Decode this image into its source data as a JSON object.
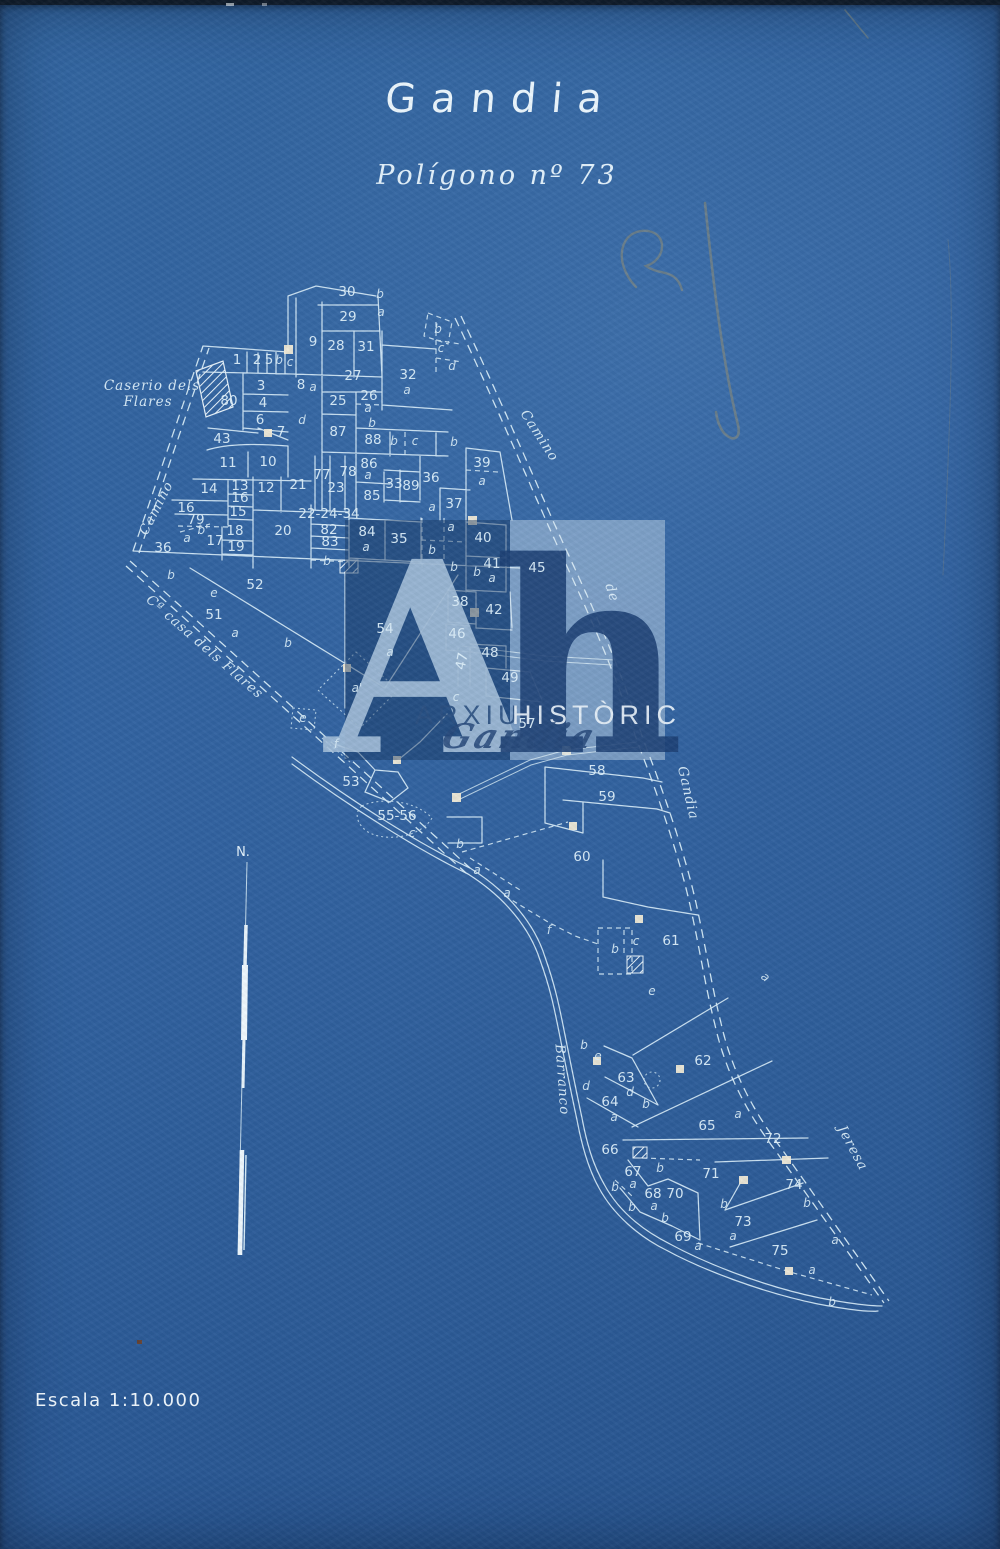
{
  "page": {
    "title": "Gandia",
    "subtitle": "Polígono nº 73",
    "scale_label": "Escala 1:10.000",
    "north_label": "N."
  },
  "colors": {
    "paper_blue": "#2e5f9e",
    "ink": "#d7ecf8",
    "watermark_dark": "#1d4075",
    "watermark_light_box": "#dce9f4",
    "building_fill": "#f1ead6",
    "pencil": "#97906f"
  },
  "watermark": {
    "letter_a": "A",
    "letter_h": "h",
    "text_1": "ARXIU",
    "text_2": "HISTÒRIC",
    "text_3": "Gandia"
  },
  "map": {
    "place_labels": [
      {
        "text": "Caserio dels",
        "x": 152,
        "y": 390,
        "rotate": 0,
        "size": 14,
        "spacing": 1
      },
      {
        "text": "Flares",
        "x": 148,
        "y": 406,
        "rotate": 0,
        "size": 14,
        "spacing": 1
      },
      {
        "text": "Camino",
        "x": 160,
        "y": 510,
        "rotate": -63,
        "size": 16,
        "spacing": 4
      },
      {
        "text": "Camino",
        "x": 536,
        "y": 438,
        "rotate": 57,
        "size": 16,
        "spacing": 9
      },
      {
        "text": "de",
        "x": 608,
        "y": 594,
        "rotate": 72,
        "size": 15,
        "spacing": 4
      },
      {
        "text": "Gandia",
        "x": 684,
        "y": 794,
        "rotate": 77,
        "size": 16,
        "spacing": 7
      },
      {
        "text": "Barranco",
        "x": 558,
        "y": 1080,
        "rotate": 86,
        "size": 16,
        "spacing": 6
      },
      {
        "text": "Jeresa",
        "x": 849,
        "y": 1150,
        "rotate": 62,
        "size": 16,
        "spacing": 7
      },
      {
        "text": "Cª casa dels Flares",
        "x": 202,
        "y": 650,
        "rotate": 41,
        "size": 13,
        "spacing": 2
      }
    ],
    "parcel_numbers": [
      {
        "text": "1",
        "x": 237,
        "y": 364
      },
      {
        "text": "2",
        "x": 257,
        "y": 364
      },
      {
        "text": "5",
        "x": 269,
        "y": 364
      },
      {
        "text": "3",
        "x": 261,
        "y": 390
      },
      {
        "text": "4",
        "x": 263,
        "y": 407
      },
      {
        "text": "6",
        "x": 260,
        "y": 424
      },
      {
        "text": "7",
        "x": 281,
        "y": 436
      },
      {
        "text": "8",
        "x": 301,
        "y": 389
      },
      {
        "text": "9",
        "x": 313,
        "y": 346
      },
      {
        "text": "10",
        "x": 268,
        "y": 466
      },
      {
        "text": "11",
        "x": 228,
        "y": 467
      },
      {
        "text": "12",
        "x": 266,
        "y": 492
      },
      {
        "text": "13",
        "x": 240,
        "y": 490
      },
      {
        "text": "14",
        "x": 209,
        "y": 493
      },
      {
        "text": "15",
        "x": 238,
        "y": 516
      },
      {
        "text": "16",
        "x": 240,
        "y": 502
      },
      {
        "text": "16",
        "x": 186,
        "y": 512
      },
      {
        "text": "79",
        "x": 196,
        "y": 524
      },
      {
        "text": "17",
        "x": 215,
        "y": 545
      },
      {
        "text": "18",
        "x": 235,
        "y": 535
      },
      {
        "text": "19",
        "x": 236,
        "y": 551
      },
      {
        "text": "20",
        "x": 283,
        "y": 535
      },
      {
        "text": "21",
        "x": 298,
        "y": 489
      },
      {
        "text": "22-24-34",
        "x": 329,
        "y": 518,
        "size": 11
      },
      {
        "text": "23",
        "x": 336,
        "y": 492
      },
      {
        "text": "25",
        "x": 338,
        "y": 405
      },
      {
        "text": "26",
        "x": 369,
        "y": 400,
        "size": 12
      },
      {
        "text": "27",
        "x": 353,
        "y": 380
      },
      {
        "text": "28",
        "x": 336,
        "y": 350
      },
      {
        "text": "29",
        "x": 348,
        "y": 321
      },
      {
        "text": "30",
        "x": 347,
        "y": 296
      },
      {
        "text": "31",
        "x": 366,
        "y": 351
      },
      {
        "text": "32",
        "x": 408,
        "y": 379
      },
      {
        "text": "33",
        "x": 394,
        "y": 488
      },
      {
        "text": "35",
        "x": 399,
        "y": 543
      },
      {
        "text": "36",
        "x": 431,
        "y": 482
      },
      {
        "text": "36",
        "x": 163,
        "y": 552
      },
      {
        "text": "37",
        "x": 454,
        "y": 508
      },
      {
        "text": "38",
        "x": 460,
        "y": 606
      },
      {
        "text": "39",
        "x": 482,
        "y": 467
      },
      {
        "text": "40",
        "x": 483,
        "y": 542
      },
      {
        "text": "41",
        "x": 492,
        "y": 568
      },
      {
        "text": "42",
        "x": 494,
        "y": 614
      },
      {
        "text": "43",
        "x": 222,
        "y": 443
      },
      {
        "text": "45",
        "x": 537,
        "y": 572,
        "size": 16
      },
      {
        "text": "46",
        "x": 457,
        "y": 638
      },
      {
        "text": "47",
        "x": 466,
        "y": 662,
        "rotate": -78
      },
      {
        "text": "48",
        "x": 490,
        "y": 657
      },
      {
        "text": "49",
        "x": 510,
        "y": 682
      },
      {
        "text": "51",
        "x": 214,
        "y": 619
      },
      {
        "text": "52",
        "x": 255,
        "y": 589
      },
      {
        "text": "53",
        "x": 351,
        "y": 786
      },
      {
        "text": "54",
        "x": 385,
        "y": 633,
        "size": 15
      },
      {
        "text": "55-56",
        "x": 397,
        "y": 820,
        "size": 12
      },
      {
        "text": "57",
        "x": 527,
        "y": 728
      },
      {
        "text": "58",
        "x": 597,
        "y": 775
      },
      {
        "text": "59",
        "x": 607,
        "y": 801
      },
      {
        "text": "60",
        "x": 582,
        "y": 861
      },
      {
        "text": "61",
        "x": 671,
        "y": 945
      },
      {
        "text": "62",
        "x": 703,
        "y": 1065
      },
      {
        "text": "63",
        "x": 626,
        "y": 1082
      },
      {
        "text": "64",
        "x": 610,
        "y": 1106
      },
      {
        "text": "65",
        "x": 707,
        "y": 1130
      },
      {
        "text": "66",
        "x": 610,
        "y": 1154
      },
      {
        "text": "67",
        "x": 633,
        "y": 1176
      },
      {
        "text": "68",
        "x": 653,
        "y": 1198
      },
      {
        "text": "69",
        "x": 683,
        "y": 1241
      },
      {
        "text": "70",
        "x": 675,
        "y": 1198
      },
      {
        "text": "71",
        "x": 711,
        "y": 1178
      },
      {
        "text": "72",
        "x": 773,
        "y": 1143
      },
      {
        "text": "73",
        "x": 743,
        "y": 1226
      },
      {
        "text": "74",
        "x": 794,
        "y": 1189
      },
      {
        "text": "75",
        "x": 780,
        "y": 1255
      },
      {
        "text": "77",
        "x": 322,
        "y": 479
      },
      {
        "text": "78",
        "x": 348,
        "y": 476
      },
      {
        "text": "80",
        "x": 229,
        "y": 405
      },
      {
        "text": "82",
        "x": 329,
        "y": 534,
        "size": 11
      },
      {
        "text": "83",
        "x": 330,
        "y": 546,
        "size": 11
      },
      {
        "text": "84",
        "x": 367,
        "y": 536
      },
      {
        "text": "85",
        "x": 372,
        "y": 500
      },
      {
        "text": "86",
        "x": 369,
        "y": 468,
        "size": 12
      },
      {
        "text": "87",
        "x": 338,
        "y": 436
      },
      {
        "text": "88",
        "x": 373,
        "y": 444
      },
      {
        "text": "89",
        "x": 411,
        "y": 490
      }
    ],
    "parcel_letters": [
      {
        "text": "b",
        "x": 380,
        "y": 298
      },
      {
        "text": "a",
        "x": 381,
        "y": 316
      },
      {
        "text": "b",
        "x": 279,
        "y": 364
      },
      {
        "text": "c",
        "x": 290,
        "y": 366
      },
      {
        "text": "b",
        "x": 438,
        "y": 333
      },
      {
        "text": "c",
        "x": 441,
        "y": 352
      },
      {
        "text": "d",
        "x": 452,
        "y": 370
      },
      {
        "text": "a",
        "x": 407,
        "y": 394
      },
      {
        "text": "a",
        "x": 313,
        "y": 391
      },
      {
        "text": "d",
        "x": 302,
        "y": 424
      },
      {
        "text": "a",
        "x": 368,
        "y": 412
      },
      {
        "text": "b",
        "x": 372,
        "y": 427
      },
      {
        "text": "b",
        "x": 394,
        "y": 445
      },
      {
        "text": "c",
        "x": 415,
        "y": 445
      },
      {
        "text": "b",
        "x": 454,
        "y": 446
      },
      {
        "text": "a",
        "x": 368,
        "y": 479
      },
      {
        "text": "a",
        "x": 432,
        "y": 511
      },
      {
        "text": "a",
        "x": 482,
        "y": 485
      },
      {
        "text": "a",
        "x": 451,
        "y": 531
      },
      {
        "text": "b",
        "x": 432,
        "y": 554
      },
      {
        "text": "b",
        "x": 454,
        "y": 571
      },
      {
        "text": "b",
        "x": 477,
        "y": 576
      },
      {
        "text": "a",
        "x": 492,
        "y": 582
      },
      {
        "text": "a",
        "x": 366,
        "y": 551
      },
      {
        "text": "b",
        "x": 327,
        "y": 565
      },
      {
        "text": "a",
        "x": 187,
        "y": 542
      },
      {
        "text": "b'",
        "x": 203,
        "y": 534
      },
      {
        "text": "b",
        "x": 171,
        "y": 579
      },
      {
        "text": "e",
        "x": 214,
        "y": 597
      },
      {
        "text": "a",
        "x": 235,
        "y": 637
      },
      {
        "text": "b",
        "x": 288,
        "y": 647
      },
      {
        "text": "a",
        "x": 390,
        "y": 656
      },
      {
        "text": "a'",
        "x": 357,
        "y": 692
      },
      {
        "text": "e",
        "x": 303,
        "y": 722
      },
      {
        "text": "f",
        "x": 336,
        "y": 748
      },
      {
        "text": "c",
        "x": 456,
        "y": 701
      },
      {
        "text": "c",
        "x": 412,
        "y": 837
      },
      {
        "text": "b",
        "x": 460,
        "y": 848
      },
      {
        "text": "a",
        "x": 477,
        "y": 874
      },
      {
        "text": "a",
        "x": 507,
        "y": 897
      },
      {
        "text": "f",
        "x": 549,
        "y": 934
      },
      {
        "text": "b",
        "x": 615,
        "y": 953
      },
      {
        "text": "c",
        "x": 636,
        "y": 945
      },
      {
        "text": "e",
        "x": 652,
        "y": 995
      },
      {
        "text": "a",
        "x": 763,
        "y": 980,
        "rotate": 40
      },
      {
        "text": "b",
        "x": 584,
        "y": 1049
      },
      {
        "text": "e",
        "x": 598,
        "y": 1060
      },
      {
        "text": "d",
        "x": 586,
        "y": 1090
      },
      {
        "text": "d",
        "x": 630,
        "y": 1096
      },
      {
        "text": "b",
        "x": 646,
        "y": 1108
      },
      {
        "text": "a",
        "x": 614,
        "y": 1121
      },
      {
        "text": "a",
        "x": 738,
        "y": 1118
      },
      {
        "text": "b",
        "x": 660,
        "y": 1172
      },
      {
        "text": "a",
        "x": 633,
        "y": 1188
      },
      {
        "text": "b",
        "x": 615,
        "y": 1191
      },
      {
        "text": "a",
        "x": 654,
        "y": 1210
      },
      {
        "text": "b",
        "x": 632,
        "y": 1211
      },
      {
        "text": "b",
        "x": 665,
        "y": 1222
      },
      {
        "text": "b",
        "x": 724,
        "y": 1208
      },
      {
        "text": "b",
        "x": 807,
        "y": 1207
      },
      {
        "text": "a",
        "x": 733,
        "y": 1240
      },
      {
        "text": "a",
        "x": 698,
        "y": 1250
      },
      {
        "text": "a",
        "x": 812,
        "y": 1274
      },
      {
        "text": "a",
        "x": 835,
        "y": 1244
      },
      {
        "text": "b",
        "x": 832,
        "y": 1306
      }
    ]
  }
}
